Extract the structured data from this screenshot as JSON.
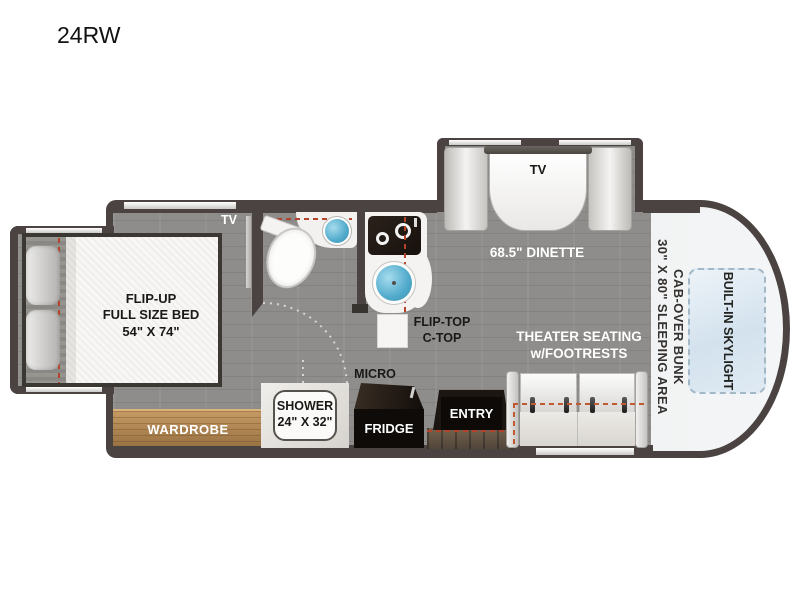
{
  "title": "24RW",
  "colors": {
    "wall": "#4a4341",
    "floor": "#8e8d8b",
    "wood": "#b28755",
    "slide_dash_red": "#b5432c",
    "slide_dash_orange": "#c05a33",
    "sink_blue": "#51aacb",
    "cab_interior": "#eef0f1",
    "skylight_blue": "#d3e2ee"
  },
  "labels": {
    "bed": {
      "l1": "FLIP-UP",
      "l2": "FULL SIZE BED",
      "l3": "54\" X 74\""
    },
    "wardrobe": "WARDROBE",
    "bedroom_tv": "TV",
    "shower": {
      "l1": "SHOWER",
      "l2": "24\" X 32\""
    },
    "flip_top": {
      "l1": "FLIP-TOP",
      "l2": "C-TOP"
    },
    "micro": "MICRO",
    "fridge": "FRIDGE",
    "entry": "ENTRY",
    "dinette": "68.5\" DINETTE",
    "dinette_tv": "TV",
    "theater": {
      "l1": "THEATER SEATING",
      "l2": "w/FOOTRESTS"
    },
    "cab_bunk": {
      "l1": "CAB-OVER BUNK",
      "l2": "30\" X 80\" SLEEPING AREA"
    },
    "skylight": "BUILT-IN SKYLIGHT"
  }
}
